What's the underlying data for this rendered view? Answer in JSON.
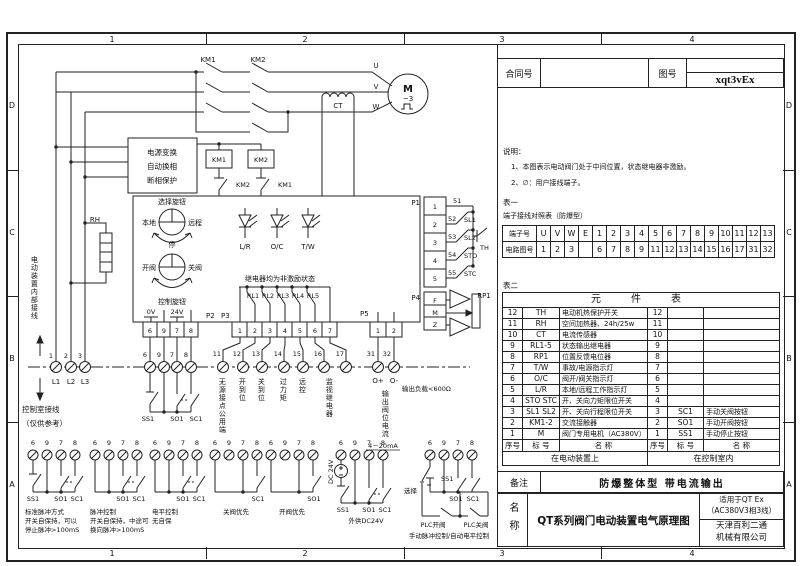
{
  "frame": {
    "cols": [
      "1",
      "2",
      "3",
      "4"
    ],
    "rows": [
      "D",
      "C",
      "B",
      "A"
    ]
  },
  "header_block": {
    "contract_label": "合同号",
    "drawing_label": "图号",
    "drawing_no": "xqt3vEx"
  },
  "notes": {
    "title": "说明：",
    "item1": "1、本图表示电动阀门处于中间位置，状态继电器非激励。",
    "item2": "2、∅：用户接线端子。"
  },
  "table1": {
    "caption": "表一",
    "subtitle": "端子接线对照表（防爆型）",
    "row1_label": "端子号",
    "row2_label": "电路图号",
    "terminals": [
      "U",
      "V",
      "W",
      "E",
      "1",
      "2",
      "3",
      "4",
      "5",
      "6",
      "7",
      "8",
      "9",
      "10",
      "11",
      "12",
      "13"
    ],
    "circuits": [
      "1",
      "2",
      "3",
      "",
      "6",
      "7",
      "8",
      "9",
      "11",
      "12",
      "13",
      "14",
      "15",
      "16",
      "17",
      "31",
      "32"
    ]
  },
  "table2": {
    "caption": "表二",
    "title": "元　件　表",
    "col_no": "序号",
    "col_tag": "标 号",
    "col_name": "名  称",
    "left_footer": "在电动装置上",
    "right_footer": "在控制室内",
    "left_rows": [
      {
        "no": "12",
        "tag": "TH",
        "name": "电动机热保护开关"
      },
      {
        "no": "11",
        "tag": "RH",
        "name": "空间加热器、24h/25w"
      },
      {
        "no": "10",
        "tag": "CT",
        "name": "电流传感器"
      },
      {
        "no": "9",
        "tag": "RL1-5",
        "name": "状态输出继电器"
      },
      {
        "no": "8",
        "tag": "RP1",
        "name": "位置反馈电位器"
      },
      {
        "no": "7",
        "tag": "T/W",
        "name": "事故/电源指示灯"
      },
      {
        "no": "6",
        "tag": "O/C",
        "name": "阀开/阀关指示灯"
      },
      {
        "no": "5",
        "tag": "L/R",
        "name": "本地/远程工作指示灯"
      },
      {
        "no": "4",
        "tag": "STO STC",
        "name": "开、关向力矩限位开关"
      },
      {
        "no": "3",
        "tag": "SL1 SL2",
        "name": "开、关向行程限位开关"
      },
      {
        "no": "2",
        "tag": "KM1-2",
        "name": "交流接触器"
      },
      {
        "no": "1",
        "tag": "M",
        "name": "阀门专用电机（AC380V）"
      }
    ],
    "right_rows": [
      {
        "no": "12",
        "tag": "",
        "name": ""
      },
      {
        "no": "11",
        "tag": "",
        "name": ""
      },
      {
        "no": "10",
        "tag": "",
        "name": ""
      },
      {
        "no": "9",
        "tag": "",
        "name": ""
      },
      {
        "no": "8",
        "tag": "",
        "name": ""
      },
      {
        "no": "7",
        "tag": "",
        "name": ""
      },
      {
        "no": "6",
        "tag": "",
        "name": ""
      },
      {
        "no": "5",
        "tag": "",
        "name": ""
      },
      {
        "no": "4",
        "tag": "",
        "name": ""
      },
      {
        "no": "3",
        "tag": "SC1",
        "name": "手动关阀按钮"
      },
      {
        "no": "2",
        "tag": "SO1",
        "name": "手动开阀按钮"
      },
      {
        "no": "1",
        "tag": "SS1",
        "name": "手动停止按钮"
      }
    ]
  },
  "remarks": {
    "label": "备注",
    "text": "防爆整体型  带电流输出"
  },
  "name_block": {
    "label": "名称",
    "title": "QT系列阀门电动装置电气原理图",
    "fit1": "适用于QT Ex",
    "fit2": "（AC380V3相3线）",
    "company1": "天津百利二通",
    "company2": "机械有限公司"
  },
  "schematic": {
    "km1": "KM1",
    "km2": "KM2",
    "u": "U",
    "v": "V",
    "w": "W",
    "motor": "M",
    "motor_sub": "~3",
    "ct": "CT",
    "pb1": "电源变换",
    "pb2": "自动换相",
    "pb3": "断相保护",
    "km1_coil": "KM1",
    "km2_coil": "KM2",
    "ilk1": "KM2",
    "ilk2": "KM1",
    "rh": "RH",
    "sel_title": "选择旋钮",
    "local": "本地",
    "remote": "远程",
    "stop": "停",
    "open": "开阀",
    "close": "关阀",
    "ctrl_title": "控制旋钮",
    "lr": "L/R",
    "oc": "O/C",
    "tw": "T/W",
    "relay_note": "继电器均为非激励状态",
    "rl1": "RL1",
    "rl2": "RL2",
    "rl3": "RL3",
    "rl4": "RL4",
    "rl5": "RL5",
    "v0": "0V",
    "v24": "24V",
    "p1": "P1",
    "p2": "P2",
    "p3": "P3",
    "p4": "P4",
    "p5": "P5",
    "p1p": [
      "1",
      "2",
      "3",
      "4",
      "5"
    ],
    "p2p": [
      "6",
      "9",
      "7",
      "8"
    ],
    "p3p": [
      "1",
      "2",
      "3",
      "4",
      "5",
      "6",
      "7"
    ],
    "p4p": [
      "F",
      "M",
      "Z"
    ],
    "p5p": [
      "1",
      "2"
    ],
    "w51": "51",
    "w52": "52",
    "w53": "53",
    "w54": "54",
    "w55": "55",
    "sl1": "SL1",
    "sl2": "SL2",
    "sto": "STO",
    "stc": "STC",
    "th": "TH",
    "rp1": "RP1",
    "t1": "1",
    "t2": "2",
    "t3": "3",
    "l1": "L1",
    "l2": "L2",
    "l3": "L3",
    "m6": "6",
    "m9": "9",
    "m7": "7",
    "m8": "8",
    "o11": "11",
    "o12": "12",
    "o13": "13",
    "o14": "14",
    "o15": "15",
    "o16": "16",
    "o17": "17",
    "o31": "31",
    "o32": "32",
    "lbl11": "无源接点公用端",
    "lbl12": "开到位",
    "lbl13": "关到位",
    "lbl14": "过力矩",
    "lbl15": "远控",
    "lbl1617": "监视继电器",
    "op": "O+",
    "om": "O-",
    "out_cur": "输出阀位电流",
    "ma": "4－20mA",
    "load": "输出负载<600Ω",
    "ss1": "SS1",
    "so1": "SO1",
    "sc1": "SC1",
    "int_note": "电动装置内部接线",
    "room1": "控制室接线",
    "room2": "（仅供参考）",
    "dc": "DC 24V",
    "sel": "选择",
    "plc_o": "PLC开阀",
    "plc_c": "PLC关阀",
    "g1c1": "标准脉冲方式",
    "g1c2": "开关自保持，可以",
    "g1c3": "停止脉冲>100mS",
    "g2c1": "脉冲控制",
    "g2c2": "开关自保持，中途可",
    "g2c3": "换向脉冲>100mS",
    "g3c1": "电平控制",
    "g3c2": "无自保",
    "g4c": "关阀优先",
    "g5c": "开阀优先",
    "g6c": "外供DC24V",
    "g7c": "手动脉冲控制/自动电平控制"
  }
}
